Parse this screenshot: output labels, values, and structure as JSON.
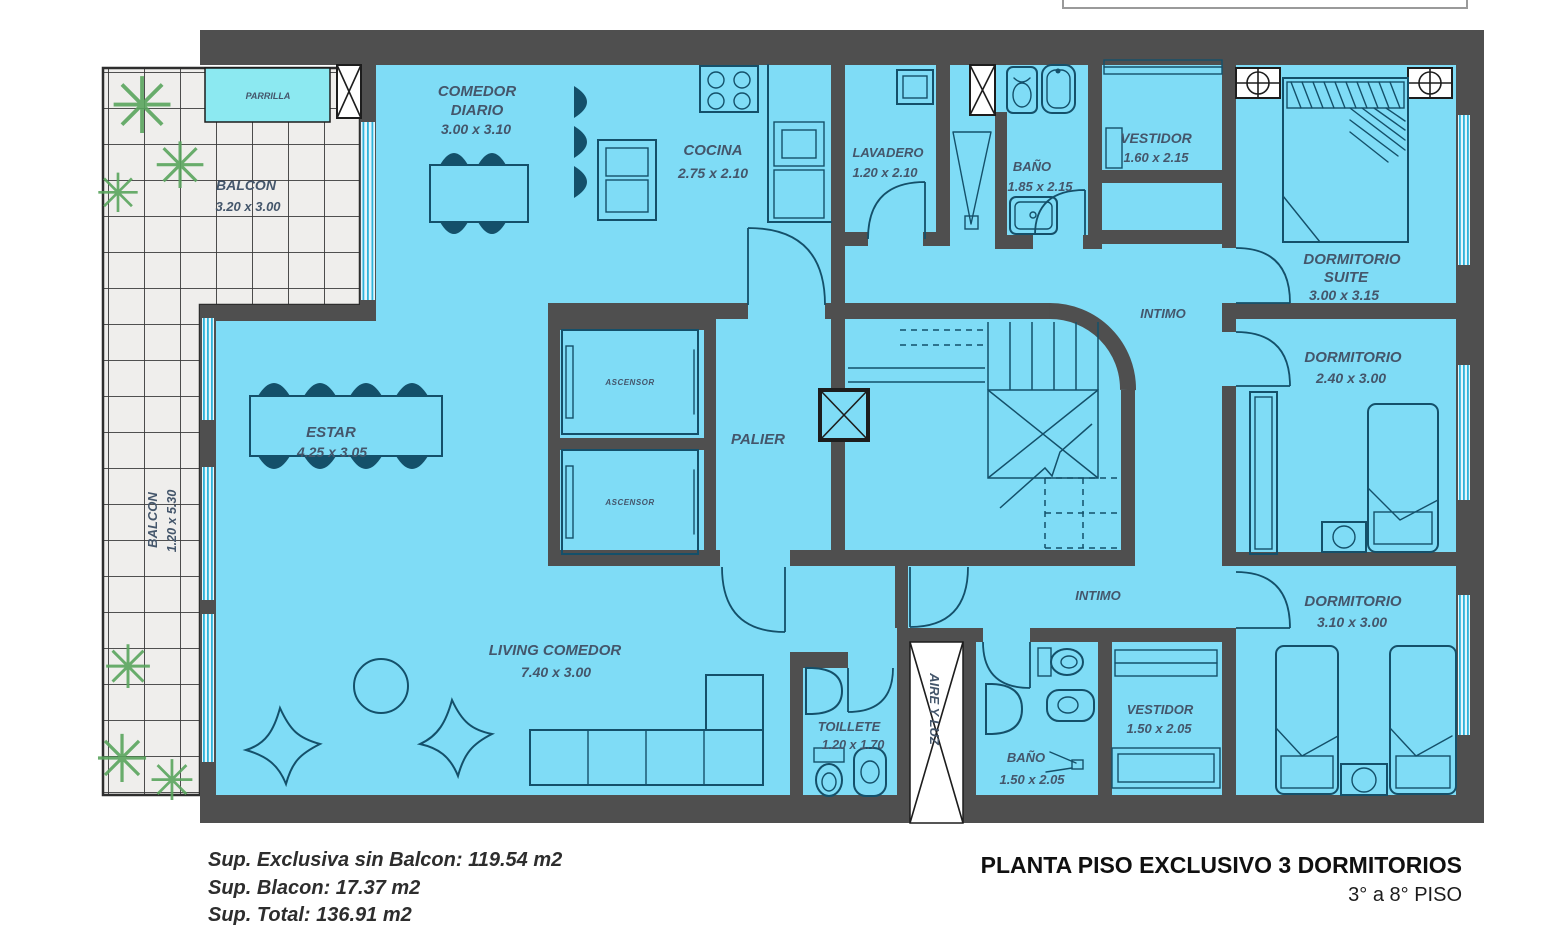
{
  "title_block": {
    "title": "PLANTA PISO EXCLUSIVO 3 DORMITORIOS",
    "subtitle": "3° a 8° PISO"
  },
  "areas": {
    "line1": "Sup. Exclusiva sin Balcon: 119.54 m2",
    "line2": "Sup. Blacon: 17.37 m2",
    "line3": "Sup. Total: 136.91 m2"
  },
  "rooms": {
    "balcon_top": {
      "name": "BALCON",
      "dims": "3.20 x 3.00"
    },
    "balcon_left": {
      "name": "BALCON",
      "dims": "1.20 x 5.30"
    },
    "parrilla": {
      "name": "PARRILLA"
    },
    "comedor_diario": {
      "line1": "COMEDOR",
      "line2": "DIARIO",
      "dims": "3.00 x 3.10"
    },
    "cocina": {
      "name": "COCINA",
      "dims": "2.75 x 2.10"
    },
    "lavadero": {
      "name": "LAVADERO",
      "dims": "1.20 x 2.10"
    },
    "bano_sup": {
      "name": "BAÑO",
      "dims": "1.85 x 2.15"
    },
    "vestidor_sup": {
      "name": "VESTIDOR",
      "dims": "1.60 x 2.15"
    },
    "dormitorio_suite": {
      "line1": "DORMITORIO",
      "line2": "SUITE",
      "dims": "3.00 x 3.15"
    },
    "intimo_sup": {
      "name": "INTIMO"
    },
    "dormitorio_medio": {
      "name": "DORMITORIO",
      "dims": "2.40 x 3.00"
    },
    "estar": {
      "name": "ESTAR",
      "dims": "4.25 x 3.05"
    },
    "ascensor": {
      "name": "ASCENSOR"
    },
    "palier": {
      "name": "PALIER"
    },
    "living_comedor": {
      "name": "LIVING COMEDOR",
      "dims": "7.40 x 3.00"
    },
    "toillete": {
      "name": "TOILLETE",
      "dims": "1.20 x 1.70"
    },
    "aire_luz": {
      "name": "AIRE Y LUZ"
    },
    "bano_inf": {
      "name": "BAÑO",
      "dims": "1.50 x 2.05"
    },
    "vestidor_inf": {
      "name": "VESTIDOR",
      "dims": "1.50 x 2.05"
    },
    "intimo_inf": {
      "name": "INTIMO"
    },
    "dormitorio_inf": {
      "name": "DORMITORIO",
      "dims": "3.10 x 3.00"
    }
  },
  "icons": {
    "plant_glyph": "✳"
  },
  "colors": {
    "wall": "#4f4f4f",
    "room_fill": "#7fdcf6",
    "furniture_line": "#14506a",
    "window_line": "#2fb3da",
    "tile_bg": "#efeeec",
    "plant_green": "#5aa55e",
    "label_text": "#44566b"
  }
}
